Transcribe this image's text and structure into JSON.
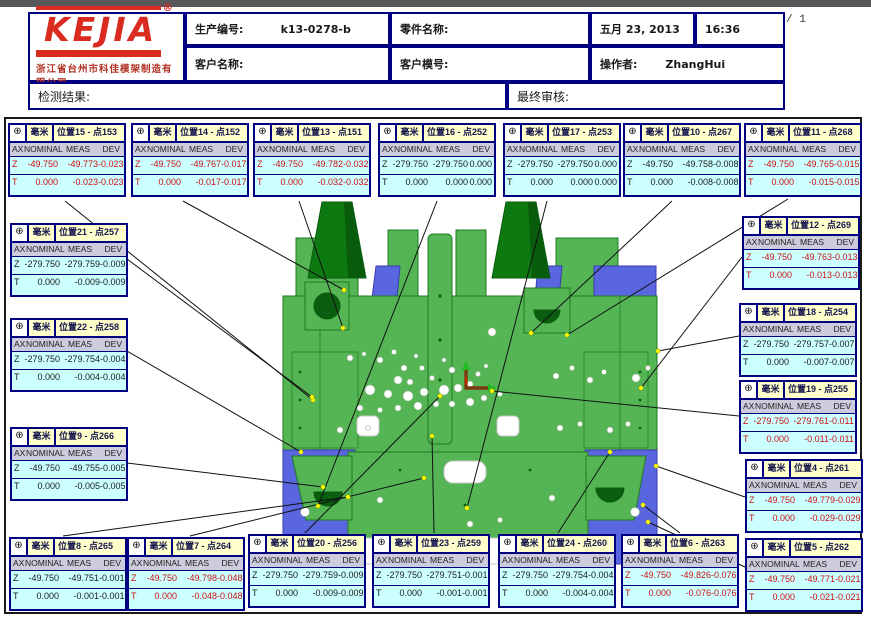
{
  "page": {
    "indicator": "/ 1"
  },
  "header": {
    "logo_text": "KEJIA",
    "logo_reg": "®",
    "company": "浙江省台州市科佳模架制造有限公司",
    "production_label": "生产编号:",
    "production_value": "k13-0278-b",
    "part_label": "零件名称:",
    "date": "五月 23, 2013",
    "time": "16:36",
    "customer_label": "客户名称:",
    "mold_label": "客户模号:",
    "operator_label": "操作者:",
    "operator_value": "ZhangHui",
    "result_label": "检测结果:",
    "review_label": "最终审核:"
  },
  "colors": {
    "box_border": "#000080",
    "box_header_bg": "#ffffcc",
    "box_body_bg": "#ccffff",
    "box_colhdr_bg": "#ccccdc",
    "alert_text": "#cc1111",
    "model_green": "#55b555",
    "model_dark_green": "#0c7a10",
    "model_blue": "#5a66e0",
    "leader_dot": "#ffff00",
    "logo_red": "#d92b1f"
  },
  "measurement": {
    "unit": "毫米",
    "icon": "⊕",
    "columns": [
      "AX",
      "NOMINAL",
      "MEAS",
      "DEV"
    ],
    "boxes": [
      {
        "title": "位置15 - 点153",
        "alert": true,
        "pos": [
          8,
          123
        ],
        "rows": [
          [
            "Z",
            "-49.750",
            "-49.773",
            "-0.023"
          ],
          [
            "T",
            "0.000",
            "-0.023",
            "-0.023"
          ]
        ]
      },
      {
        "title": "位置14 - 点152",
        "alert": true,
        "pos": [
          131,
          123
        ],
        "rows": [
          [
            "Z",
            "-49.750",
            "-49.767",
            "-0.017"
          ],
          [
            "T",
            "0.000",
            "-0.017",
            "-0.017"
          ]
        ]
      },
      {
        "title": "位置13 - 点151",
        "alert": true,
        "pos": [
          253,
          123
        ],
        "rows": [
          [
            "Z",
            "-49.750",
            "-49.782",
            "-0.032"
          ],
          [
            "T",
            "0.000",
            "-0.032",
            "-0.032"
          ]
        ]
      },
      {
        "title": "位置16 - 点252",
        "alert": false,
        "pos": [
          378,
          123
        ],
        "rows": [
          [
            "Z",
            "-279.750",
            "-279.750",
            "0.000"
          ],
          [
            "T",
            "0.000",
            "0.000",
            "0.000"
          ]
        ]
      },
      {
        "title": "位置17 - 点253",
        "alert": false,
        "pos": [
          503,
          123
        ],
        "rows": [
          [
            "Z",
            "-279.750",
            "-279.750",
            "0.000"
          ],
          [
            "T",
            "0.000",
            "0.000",
            "0.000"
          ]
        ]
      },
      {
        "title": "位置10 - 点267",
        "alert": false,
        "pos": [
          623,
          123
        ],
        "rows": [
          [
            "Z",
            "-49.750",
            "-49.758",
            "-0.008"
          ],
          [
            "T",
            "0.000",
            "-0.008",
            "-0.008"
          ]
        ]
      },
      {
        "title": "位置11 - 点268",
        "alert": true,
        "pos": [
          744,
          123
        ],
        "rows": [
          [
            "Z",
            "-49.750",
            "-49.765",
            "-0.015"
          ],
          [
            "T",
            "0.000",
            "-0.015",
            "-0.015"
          ]
        ]
      },
      {
        "title": "位置12 - 点269",
        "alert": true,
        "pos": [
          742,
          216
        ],
        "rows": [
          [
            "Z",
            "-49.750",
            "-49.763",
            "-0.013"
          ],
          [
            "T",
            "0.000",
            "-0.013",
            "-0.013"
          ]
        ]
      },
      {
        "title": "位置18 - 点254",
        "alert": false,
        "pos": [
          739,
          303
        ],
        "rows": [
          [
            "Z",
            "-279.750",
            "-279.757",
            "-0.007"
          ],
          [
            "T",
            "0.000",
            "-0.007",
            "-0.007"
          ]
        ]
      },
      {
        "title": "位置19 - 点255",
        "alert": true,
        "pos": [
          739,
          380
        ],
        "rows": [
          [
            "Z",
            "-279.750",
            "-279.761",
            "-0.011"
          ],
          [
            "T",
            "0.000",
            "-0.011",
            "-0.011"
          ]
        ]
      },
      {
        "title": "位置4 - 点261",
        "alert": true,
        "pos": [
          745,
          459
        ],
        "rows": [
          [
            "Z",
            "-49.750",
            "-49.779",
            "-0.029"
          ],
          [
            "T",
            "0.000",
            "-0.029",
            "-0.029"
          ]
        ]
      },
      {
        "title": "位置5 - 点262",
        "alert": true,
        "pos": [
          745,
          538
        ],
        "rows": [
          [
            "Z",
            "-49.750",
            "-49.771",
            "-0.021"
          ],
          [
            "T",
            "0.000",
            "-0.021",
            "-0.021"
          ]
        ]
      },
      {
        "title": "位置21 - 点257",
        "alert": false,
        "pos": [
          10,
          223
        ],
        "rows": [
          [
            "Z",
            "-279.750",
            "-279.759",
            "-0.009"
          ],
          [
            "T",
            "0.000",
            "-0.009",
            "-0.009"
          ]
        ]
      },
      {
        "title": "位置22 - 点258",
        "alert": false,
        "pos": [
          10,
          318
        ],
        "rows": [
          [
            "Z",
            "-279.750",
            "-279.754",
            "-0.004"
          ],
          [
            "T",
            "0.000",
            "-0.004",
            "-0.004"
          ]
        ]
      },
      {
        "title": "位置9 - 点266",
        "alert": false,
        "pos": [
          10,
          427
        ],
        "rows": [
          [
            "Z",
            "-49.750",
            "-49.755",
            "-0.005"
          ],
          [
            "T",
            "0.000",
            "-0.005",
            "-0.005"
          ]
        ]
      },
      {
        "title": "位置8 - 点265",
        "alert": false,
        "pos": [
          9,
          537
        ],
        "rows": [
          [
            "Z",
            "-49.750",
            "-49.751",
            "-0.001"
          ],
          [
            "T",
            "0.000",
            "-0.001",
            "-0.001"
          ]
        ]
      },
      {
        "title": "位置7 - 点264",
        "alert": true,
        "pos": [
          127,
          537
        ],
        "rows": [
          [
            "Z",
            "-49.750",
            "-49.798",
            "-0.048"
          ],
          [
            "T",
            "0.000",
            "-0.048",
            "-0.048"
          ]
        ]
      },
      {
        "title": "位置20 - 点256",
        "alert": false,
        "pos": [
          248,
          534
        ],
        "rows": [
          [
            "Z",
            "-279.750",
            "-279.759",
            "-0.009"
          ],
          [
            "T",
            "0.000",
            "-0.009",
            "-0.009"
          ]
        ]
      },
      {
        "title": "位置23 - 点259",
        "alert": false,
        "pos": [
          372,
          534
        ],
        "rows": [
          [
            "Z",
            "-279.750",
            "-279.751",
            "-0.001"
          ],
          [
            "T",
            "0.000",
            "-0.001",
            "-0.001"
          ]
        ]
      },
      {
        "title": "位置24 - 点260",
        "alert": false,
        "pos": [
          498,
          534
        ],
        "rows": [
          [
            "Z",
            "-279.750",
            "-279.754",
            "-0.004"
          ],
          [
            "T",
            "0.000",
            "-0.004",
            "-0.004"
          ]
        ]
      },
      {
        "title": "位置6 - 点263",
        "alert": true,
        "pos": [
          621,
          534
        ],
        "rows": [
          [
            "Z",
            "-49.750",
            "-49.826",
            "-0.076"
          ],
          [
            "T",
            "0.000",
            "-0.076",
            "-0.076"
          ]
        ]
      }
    ]
  }
}
